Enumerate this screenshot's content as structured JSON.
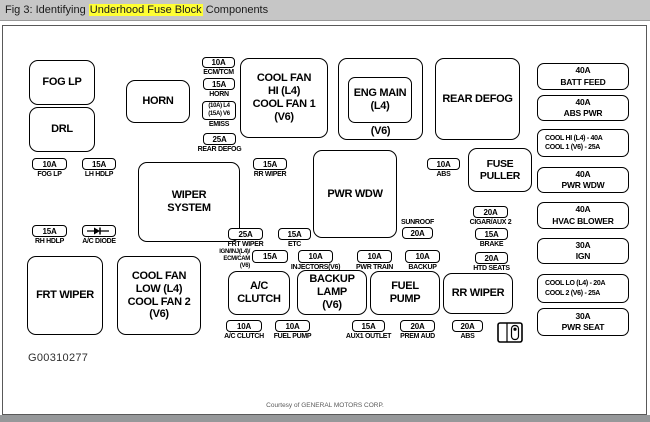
{
  "header": {
    "prefix": "Fig 3: Identifying ",
    "highlight": "Underhood Fuse Block",
    "suffix": " Components",
    "highlight_color": "#ffff33"
  },
  "blocks": {
    "fog_lp": "FOG LP",
    "drl": "DRL",
    "horn": "HORN",
    "cool_fan_hi": "COOL FAN\nHI (L4)\nCOOL FAN 1\n(V6)",
    "rear_defog": "REAR DEFOG",
    "wiper_system": "WIPER\nSYSTEM",
    "pwr_wdw": "PWR WDW",
    "fuse_puller": "FUSE\nPULLER",
    "frt_wiper": "FRT WIPER",
    "cool_fan_low": "COOL FAN\nLOW (L4)\nCOOL FAN 2\n(V6)",
    "ac_clutch": "A/C\nCLUTCH",
    "backup_lamp": "BACKUP\nLAMP\n(V6)",
    "fuel_pump": "FUEL\nPUMP",
    "rr_wiper": "RR WIPER"
  },
  "eng_main": {
    "inner": "ENG MAIN\n(L4)",
    "below": "(V6)"
  },
  "fuses": [
    {
      "amp": "10A",
      "label": "ECM/TCM"
    },
    {
      "amp": "15A",
      "label": "HORN"
    },
    {
      "amp": "(10A) L4\n(15A) V6",
      "label": "EMISS"
    },
    {
      "amp": "25A",
      "label": "REAR DEFOG"
    },
    {
      "amp": "10A",
      "label": "FOG LP"
    },
    {
      "amp": "15A",
      "label": "LH HDLP"
    },
    {
      "amp": "15A",
      "label": "RH HDLP"
    },
    {
      "symbol": "diode",
      "label": "A/C DIODE"
    },
    {
      "amp": "15A",
      "label": "RR WIPER"
    },
    {
      "amp": "10A",
      "label": "ABS"
    },
    {
      "amp": "25A",
      "label": "FRT WIPER"
    },
    {
      "amp": "15A",
      "label": "ETC"
    },
    {
      "amp": "20A",
      "label": "SUNROOF"
    },
    {
      "amp": "20A",
      "label": "CIGAR/AUX 2"
    },
    {
      "amp": "15A",
      "label": "BRAKE"
    },
    {
      "amp": "20A",
      "label": "HTD SEATS"
    },
    {
      "amp": "15A",
      "label": "IGN/INJ(L4)/\nECM/CAM (V6)"
    },
    {
      "amp": "10A",
      "label": "INJECTORS(V6)"
    },
    {
      "amp": "10A",
      "label": "PWR TRAIN"
    },
    {
      "amp": "10A",
      "label": "BACKUP"
    },
    {
      "amp": "10A",
      "label": "A/C CLUTCH"
    },
    {
      "amp": "10A",
      "label": "FUEL PUMP"
    },
    {
      "amp": "15A",
      "label": "AUX1 OUTLET"
    },
    {
      "amp": "20A",
      "label": "PREM AUD"
    },
    {
      "amp": "20A",
      "label": "ABS"
    }
  ],
  "right_column": [
    {
      "line1": "40A",
      "line2": "BATT FEED"
    },
    {
      "line1": "40A",
      "line2": "ABS PWR"
    },
    {
      "line1": "COOL HI (L4) - 40A",
      "line2": "COOL 1 (V6) - 25A"
    },
    {
      "line1": "40A",
      "line2": "PWR WDW"
    },
    {
      "line1": "40A",
      "line2": "HVAC BLOWER"
    },
    {
      "line1": "30A",
      "line2": "IGN"
    },
    {
      "line1": "COOL LO (L4) - 20A",
      "line2": "COOL 2 (V6) - 25A"
    },
    {
      "line1": "30A",
      "line2": "PWR SEAT"
    }
  ],
  "footer": {
    "code": "G00310277",
    "courtesy": "Courtesy of GENERAL MOTORS CORP."
  }
}
